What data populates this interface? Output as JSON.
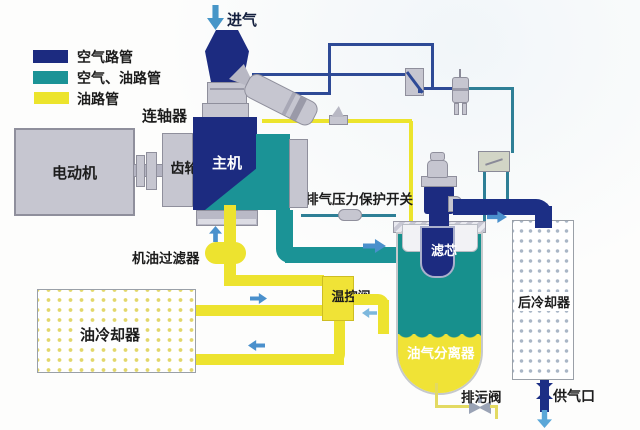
{
  "legend": {
    "items": [
      {
        "label": "空气路管",
        "color": "#1c2b80"
      },
      {
        "label": "空气、油路管",
        "color": "#1b9396"
      },
      {
        "label": "油路管",
        "color": "#ece42c"
      }
    ]
  },
  "labels": {
    "intake": "进气",
    "motor": "电动机",
    "coupling": "连轴器",
    "gearbox": "齿轮箱",
    "airend": "主机",
    "pressure_switch": "排气压力保护开关",
    "oil_filter": "机油过滤器",
    "oil_cooler": "油冷却器",
    "temp_valve": "温控阀",
    "filter_element": "滤芯",
    "separator": "油气分离器",
    "after_cooler": "后冷却器",
    "drain_valve": "排污阀",
    "air_outlet": "供气口"
  },
  "colors": {
    "air_pipe": "#1c2b80",
    "air_oil_pipe": "#1b9396",
    "oil_pipe": "#ece42c",
    "flow_arrow": "#4a90cc",
    "component_gray": "#c6c6d0"
  }
}
